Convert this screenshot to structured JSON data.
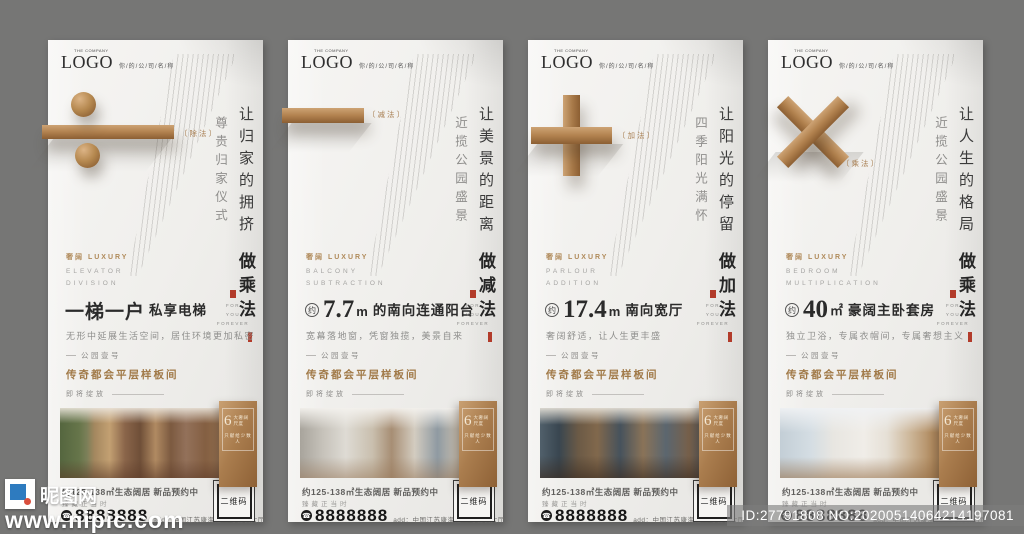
{
  "canvas": {
    "bg_color": "#767675",
    "bronze": "#a97e52",
    "seal_red": "#b23b2a"
  },
  "shared": {
    "logo": {
      "pre": "THE COMPANY",
      "text": "LOGO",
      "company": "你/的/公/司/名/称"
    },
    "luxury": "奢阔 LUXURY",
    "for_you": [
      "FOR",
      "YOU",
      "FOREVER"
    ],
    "ribbon": {
      "big": "6",
      "l1": "大奢阔尺度",
      "l2": "只献给少数人"
    },
    "divider": {
      "l1": "公园壹号",
      "l2": "传奇都会平层样板间",
      "l3": "即将绽放"
    },
    "bottom": {
      "area": "约125-138㎡生态阔居 新品预约中",
      "sub": "臻藏正当时",
      "phone": "8888888",
      "address": "add：中国江苏康海路15号营销大厅",
      "qr": "二维码"
    }
  },
  "watermark": {
    "site": "昵图网",
    "url": "www.nipic.com",
    "id_no": "ID:27791808 NO:20200514064214197081"
  },
  "posters": [
    {
      "math": "division",
      "label": "〔除法〕",
      "v_sub": "尊贵归家仪式",
      "v_main": "让归家的拥挤",
      "v_bold": "做乘法",
      "en1": "ELEVATOR",
      "en2": "DIVISION",
      "h_big": "一梯一户",
      "h_rest": "私享电梯",
      "desc": "无形中延展生活空间，居住环境更加私密"
    },
    {
      "math": "subtraction",
      "label": "〔减法〕",
      "v_sub": "近揽公园盛景",
      "v_main": "让美景的距离",
      "v_bold": "做减法",
      "en1": "BALCONY",
      "en2": "SUBTRACTION",
      "h_approx": "约",
      "h_big": "7.7",
      "h_unit": "m",
      "h_rest": "的南向连通阳台",
      "desc": "宽幕落地窗，凭窗独揽，美景自来"
    },
    {
      "math": "addition",
      "label": "〔加法〕",
      "v_sub": "四季阳光满怀",
      "v_main": "让阳光的停留",
      "v_bold": "做加法",
      "en1": "PARLOUR",
      "en2": "ADDITION",
      "h_approx": "约",
      "h_big": "17.4",
      "h_unit": "m",
      "h_rest": "南向宽厅",
      "desc": "奢阔舒适，让人生更丰盛"
    },
    {
      "math": "multiplication",
      "label": "〔乘法〕",
      "v_sub": "近揽公园盛景",
      "v_main": "让人生的格局",
      "v_bold": "做乘法",
      "en1": "BEDROOM",
      "en2": "MULTIPLICATION",
      "h_approx": "约",
      "h_big": "40",
      "h_unit": "㎡",
      "h_rest": "豪阔主卧套房",
      "desc": "独立卫浴，专属衣帽间，专属奢想主义"
    }
  ]
}
